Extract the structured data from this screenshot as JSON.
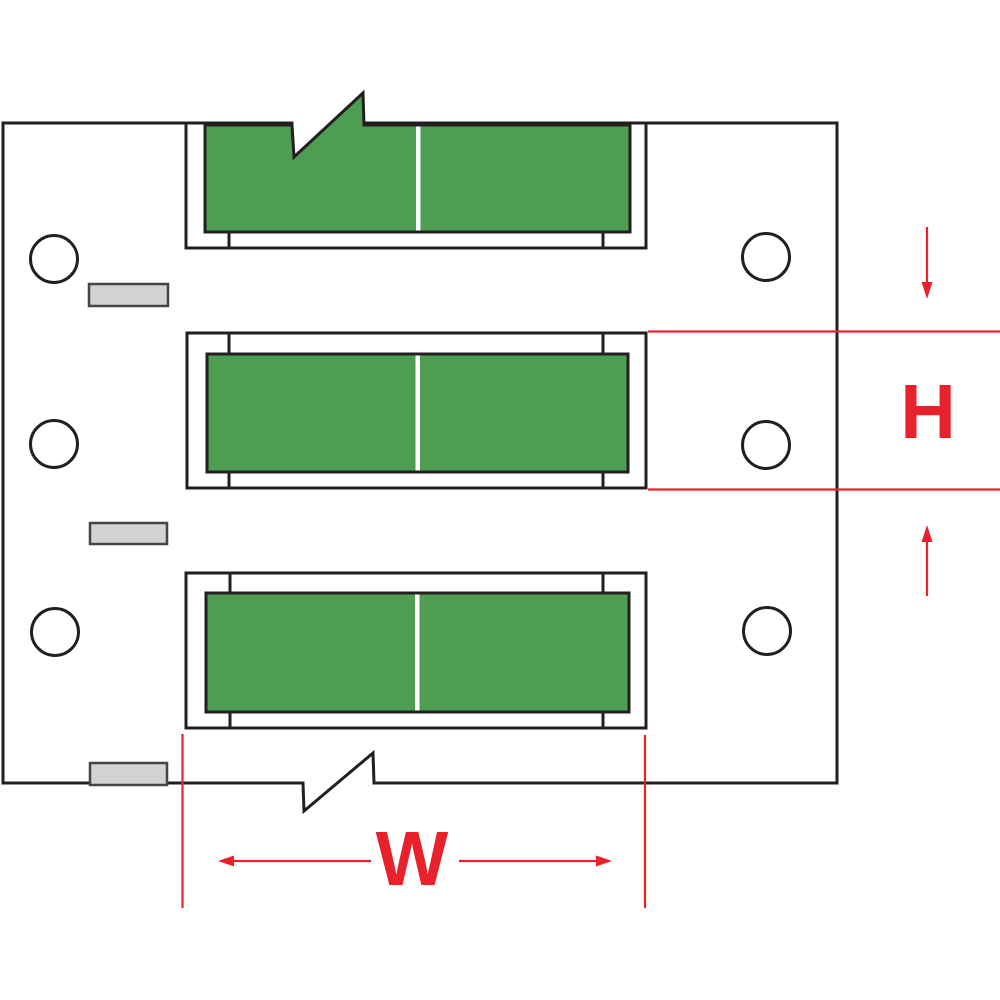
{
  "labels": {
    "height": "H",
    "width": "W"
  },
  "colors": {
    "bg": "#ffffff",
    "line": "#231f20",
    "green": "#4f9c53",
    "red": "#e8212b",
    "gray_fill": "#d3d3d5",
    "gray_border": "#454545"
  }
}
